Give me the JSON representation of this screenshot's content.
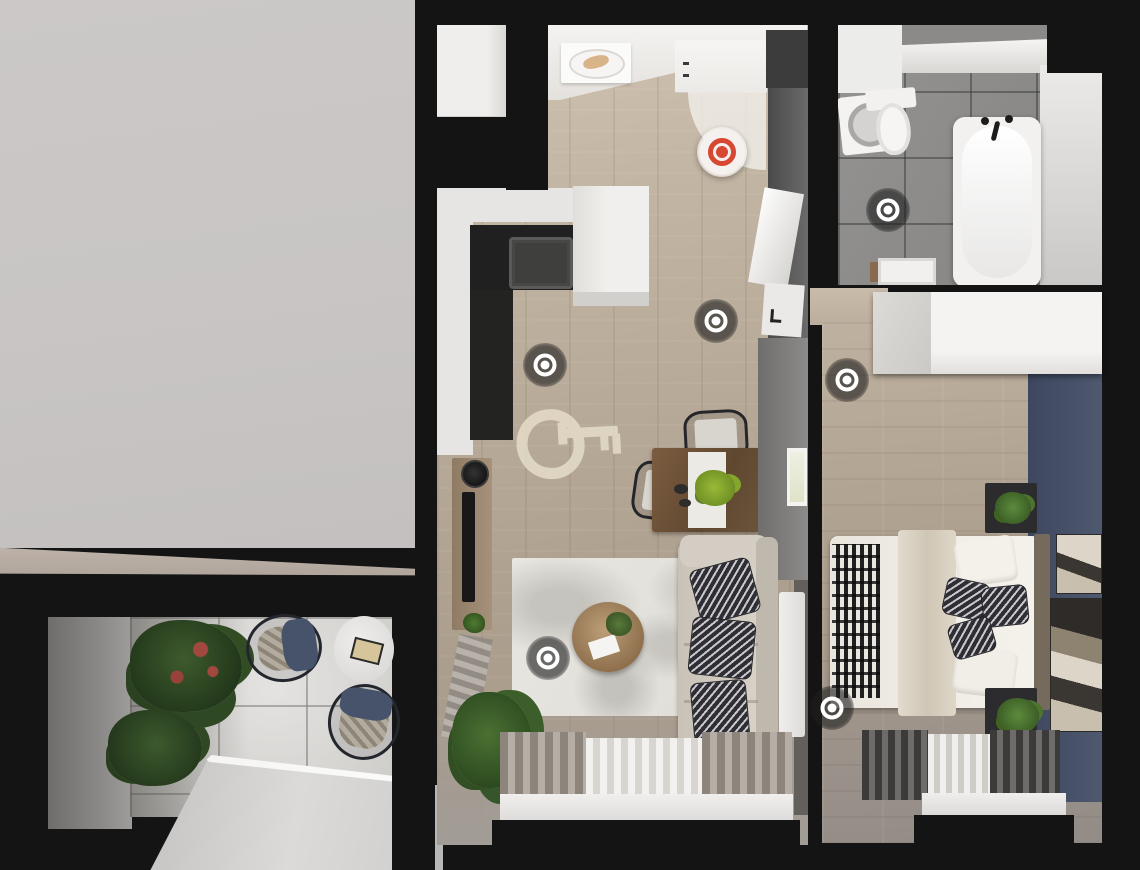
{
  "scene": {
    "view": "top-down-3d-apartment-floorplan",
    "watermark_icon": "key-icon",
    "colors": {
      "wall_black": "#141414",
      "exterior_gray": "#c9c6c5",
      "ledge_beige": "#b9ada2",
      "wood_floor": "#b5a795",
      "bath_tile": "#8e8d8c",
      "accent_navy_wall": "#475168",
      "marker_red": "#d84731",
      "marker_ring_white": "#ffffff",
      "marker_dark_bg": "rgba(30,30,30,0.62)"
    }
  },
  "markers": [
    {
      "id": "entrance-active",
      "type": "red",
      "x": 722,
      "y": 152
    },
    {
      "id": "hallway",
      "type": "dark",
      "x": 716,
      "y": 321
    },
    {
      "id": "kitchen",
      "type": "dark",
      "x": 545,
      "y": 365
    },
    {
      "id": "living-room",
      "type": "dark",
      "x": 548,
      "y": 658
    },
    {
      "id": "bathroom",
      "type": "dark",
      "x": 888,
      "y": 210
    },
    {
      "id": "bedroom-a",
      "type": "dark",
      "x": 847,
      "y": 380
    },
    {
      "id": "bedroom-b",
      "type": "dark",
      "x": 832,
      "y": 708
    }
  ],
  "rooms": [
    {
      "id": "kitchen-living-room",
      "furniture": [
        "fridge",
        "kitchen-counter",
        "sink",
        "entrance-door",
        "dining-table",
        "dining-chairs",
        "sofa",
        "coffee-table",
        "rug",
        "tv-console",
        "plants",
        "window-curtains"
      ]
    },
    {
      "id": "bathroom",
      "furniture": [
        "washing-machine",
        "toilet",
        "bathtub",
        "sink-cabinet"
      ]
    },
    {
      "id": "bedroom",
      "furniture": [
        "wardrobe",
        "double-bed",
        "nightstands",
        "wall-artwork",
        "window-curtains"
      ]
    },
    {
      "id": "balcony",
      "furniture": [
        "wicker-chairs",
        "round-table",
        "potted-plants"
      ]
    }
  ]
}
